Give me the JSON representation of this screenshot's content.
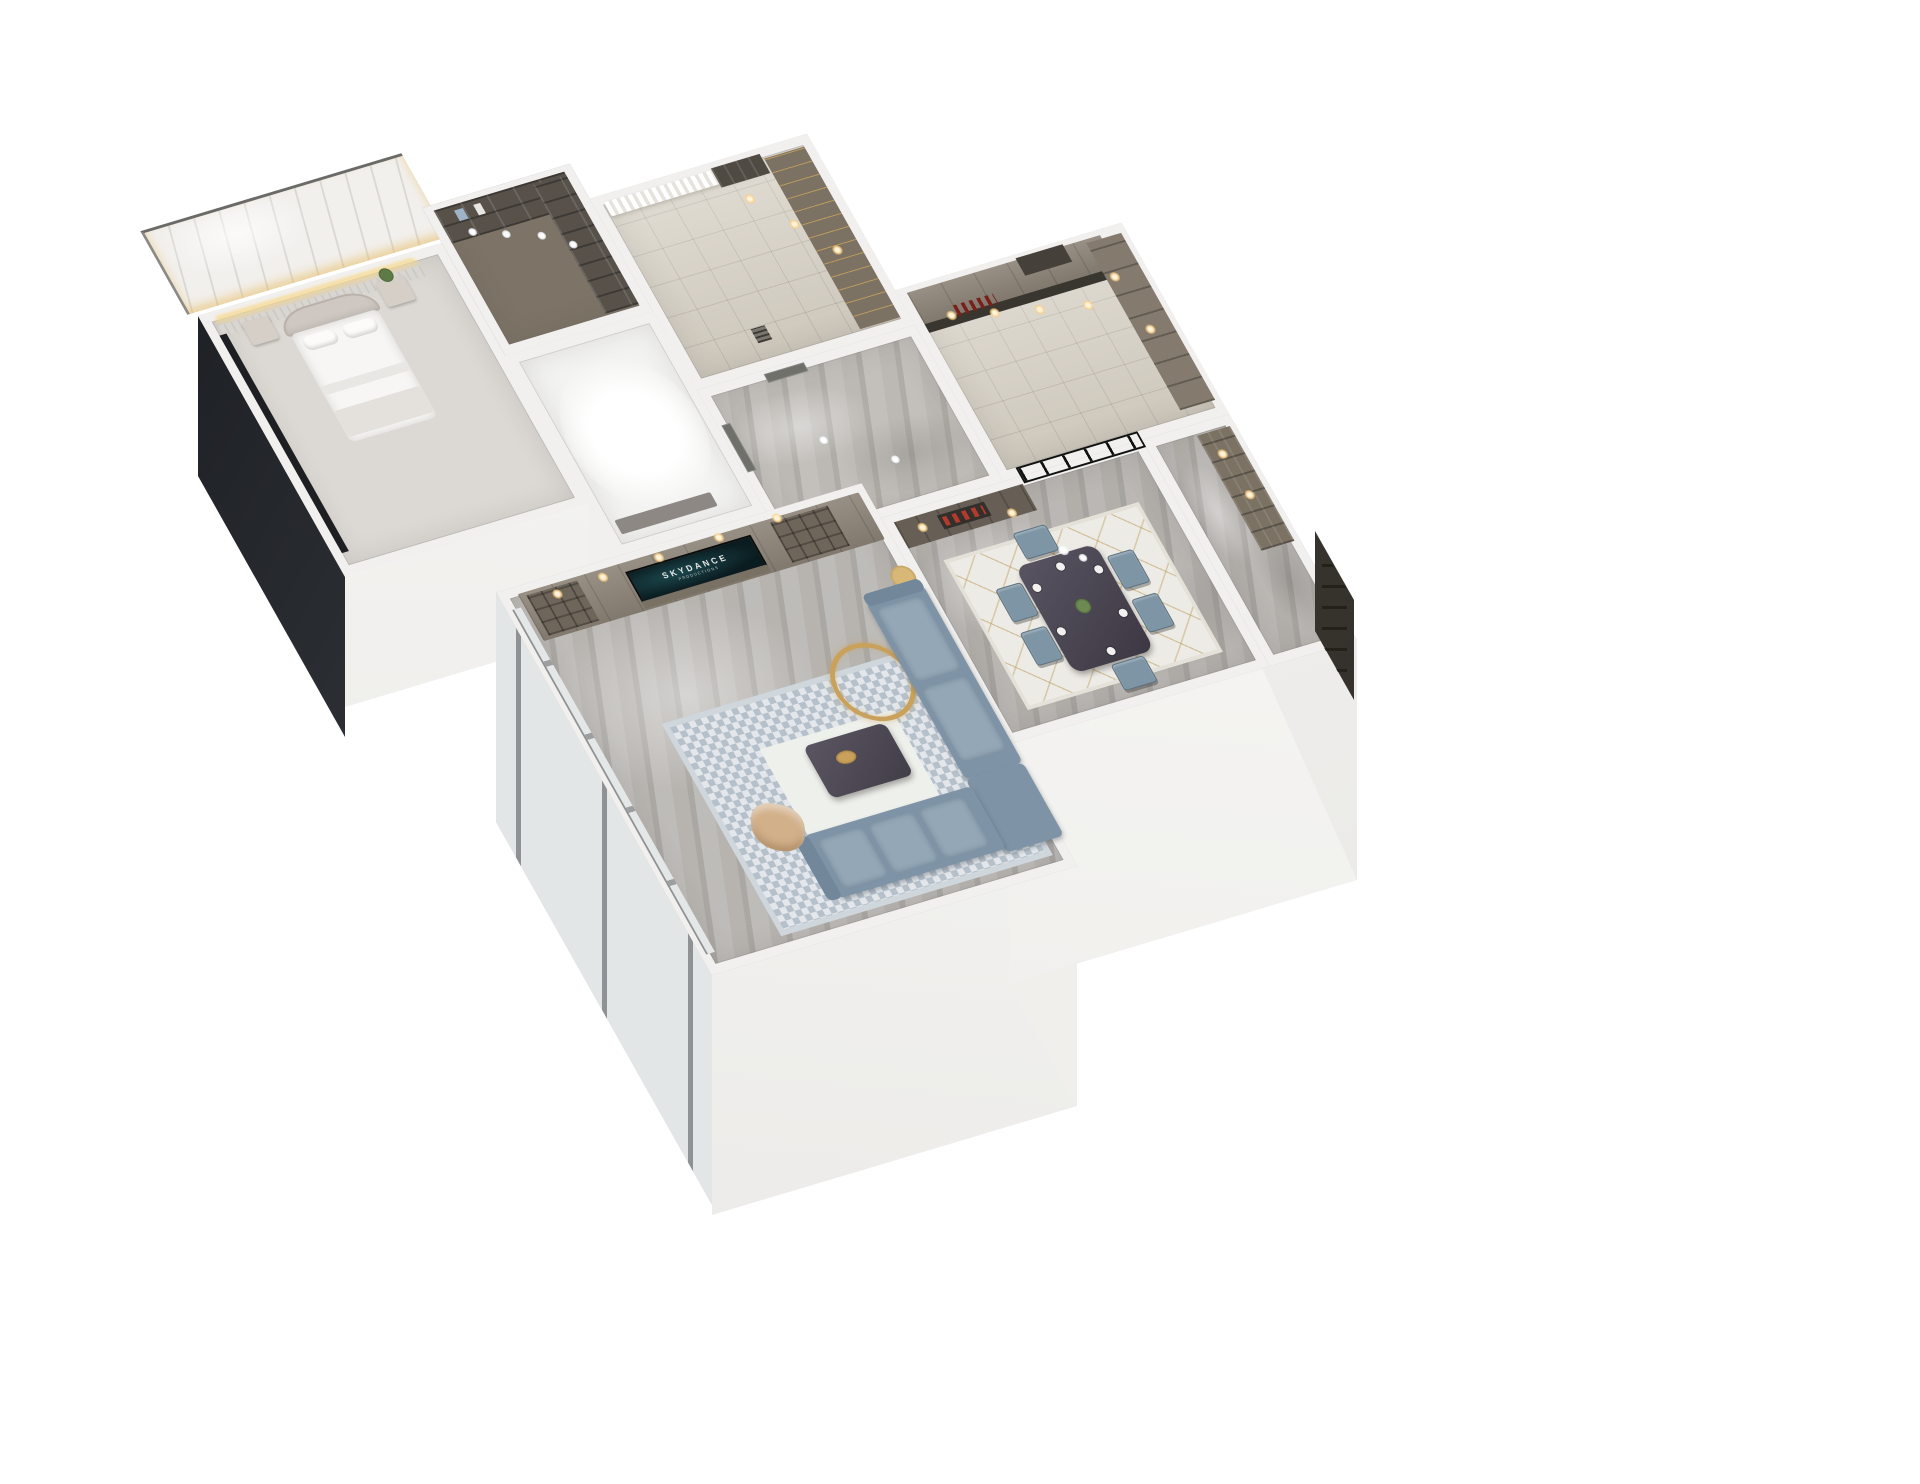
{
  "scene": {
    "title": "3D isometric apartment floor plan render",
    "view": "dollhouse cutaway from above",
    "background": "#ffffff"
  },
  "tv": {
    "brand_text": "SKYDANCE",
    "brand_subtext": "PRODUCTIONS"
  },
  "palette": {
    "wall_top": "#f1f0ee",
    "marble_floor": "#b7b4b0",
    "tile_floor": "#d8d2c6",
    "cabinet_taupe": "#8c8377",
    "cabinet_dark": "#675f55",
    "shelf_dark": "#57514a",
    "sofa_blue": "#7e94a6",
    "chair_blue": "#7e95a5",
    "rug_blue": "#c6cfd7",
    "rug_dining": "#edebe5",
    "gold_accent": "#c9a15a",
    "warm_light": "#ffd98f",
    "glass_dark": "#2c302d",
    "entry_door": "#45413a",
    "accent_red": "#b33b2e",
    "accent_tan": "#d2b08a",
    "tv_screen": "#0b1c20"
  },
  "rooms": [
    {
      "id": "master-bedroom",
      "label": "Master bedroom",
      "key_items": [
        "arched upholstered headboard bed",
        "two nightstands",
        "potted plant",
        "warm LED cove light",
        "marble ceiling slab",
        "dark glazed window wall"
      ]
    },
    {
      "id": "walk-in-closet",
      "label": "Walk-in closet",
      "key_items": [
        "dark open shelving",
        "white downlights",
        "hanging clothes"
      ]
    },
    {
      "id": "bathroom",
      "label": "Bright white bathroom",
      "key_items": [
        "white floor glow",
        "vanity counter"
      ]
    },
    {
      "id": "dressing-room",
      "label": "Dressing room",
      "key_items": [
        "sheer curtains",
        "taupe wardrobes with gold pulls",
        "floor drain",
        "warm downlights"
      ]
    },
    {
      "id": "kitchen",
      "label": "Kitchen",
      "key_items": [
        "taupe upper cabinets",
        "dark counter",
        "wine bottles",
        "range hood",
        "warm downlights"
      ]
    },
    {
      "id": "hallway",
      "label": "Hallway",
      "key_items": [
        "gray marble floor",
        "two gray doors"
      ]
    },
    {
      "id": "dining-room",
      "label": "Dining room",
      "key_items": [
        "dark marble dining table",
        "six blue chairs",
        "white rug with gold lines",
        "display cabinet with red decor",
        "black framed glass partition",
        "pendant lights"
      ]
    },
    {
      "id": "entry",
      "label": "Entry",
      "key_items": [
        "tall display shelf",
        "dark paneled entry door"
      ]
    },
    {
      "id": "living-room",
      "label": "Living room",
      "key_items": [
        "TV wall with taupe cabinets",
        "TV showing Skydance logo",
        "blue-gray sectional sofas",
        "gold ring floor lamp",
        "dark coffee table with gold tray",
        "tan accent chair",
        "blue patterned rug",
        "floor-to-ceiling windows"
      ]
    }
  ]
}
